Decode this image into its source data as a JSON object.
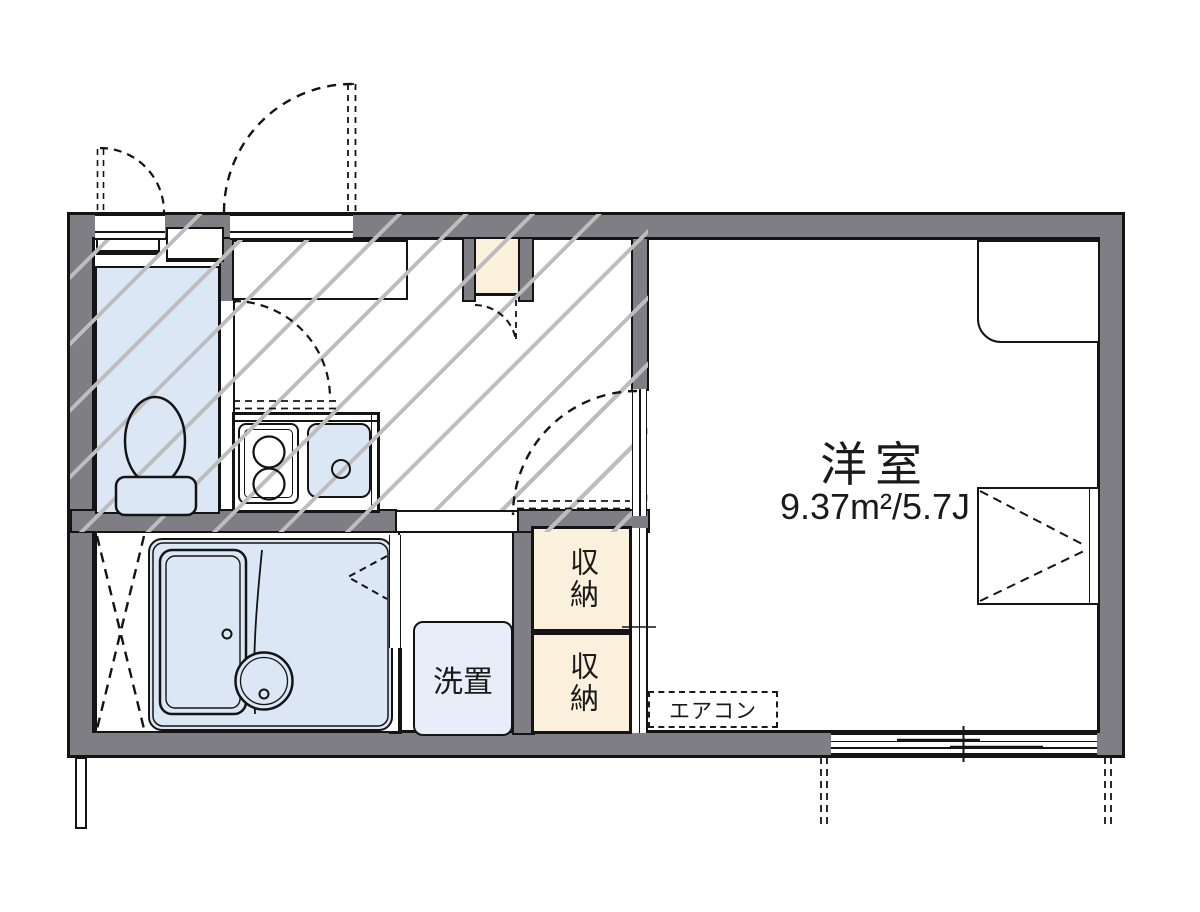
{
  "plan": {
    "main_room": {
      "name": "洋室",
      "area": "9.37m²/5.7J"
    },
    "storage_upper": {
      "label": "収納"
    },
    "storage_lower": {
      "label": "収納"
    },
    "washer_space": {
      "label": "洗置"
    },
    "air_conditioner": {
      "label": "エアコン"
    }
  },
  "colors": {
    "wall_gray": "#7e7e84",
    "outline_black": "#141414",
    "water_fixture_blue": "#dce7f6",
    "washer_blue": "#e7edf9",
    "storage_cream": "#faf0dc",
    "hatch_gray": "#bdbdbd"
  }
}
